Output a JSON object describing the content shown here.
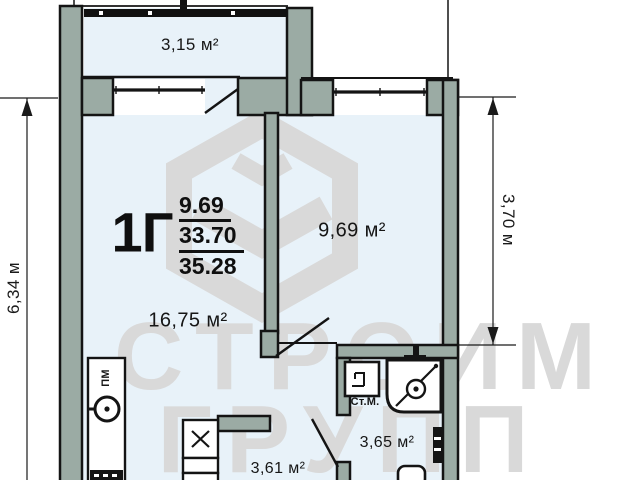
{
  "plan_title": "apartment-floor-plan",
  "apartment": {
    "type_label": "1Г",
    "stacked_values": {
      "top": "9.69",
      "middle": "33.70",
      "bottom": "35.28"
    }
  },
  "rooms": {
    "balcony": "3,15 м²",
    "living": "16,75 м²",
    "bedroom": "9,69 м²",
    "bathroom": "3,65 м²",
    "hallway": "3,61 м²"
  },
  "fixtures": {
    "washing_machine_label": "Ст.М.",
    "dishwasher_label": "ПМ"
  },
  "dimensions": {
    "left": "6,34 м",
    "right": "3,70 м"
  },
  "watermark": {
    "line1": "СТРОИМ",
    "line2": "ГРУПП"
  },
  "icons": {
    "logo": "cube-3d-logo-icon",
    "sink": "hob-circle-icon",
    "stove": "hatched-stove-icon",
    "kitchen_cabinet": "cabinet-x-icon",
    "washing_machine": "washing-machine-icon",
    "shower": "shower-cabin-icon",
    "toilet": "toilet-icon",
    "vent": "radiator-vent-icon",
    "railing": "balcony-railing"
  },
  "colors": {
    "wall_fill": "#9baba4",
    "floor_fill": "#e8f2f9",
    "outline": "#141414",
    "watermark": "#d9d9d9",
    "dimension": "#1a1a1a"
  }
}
